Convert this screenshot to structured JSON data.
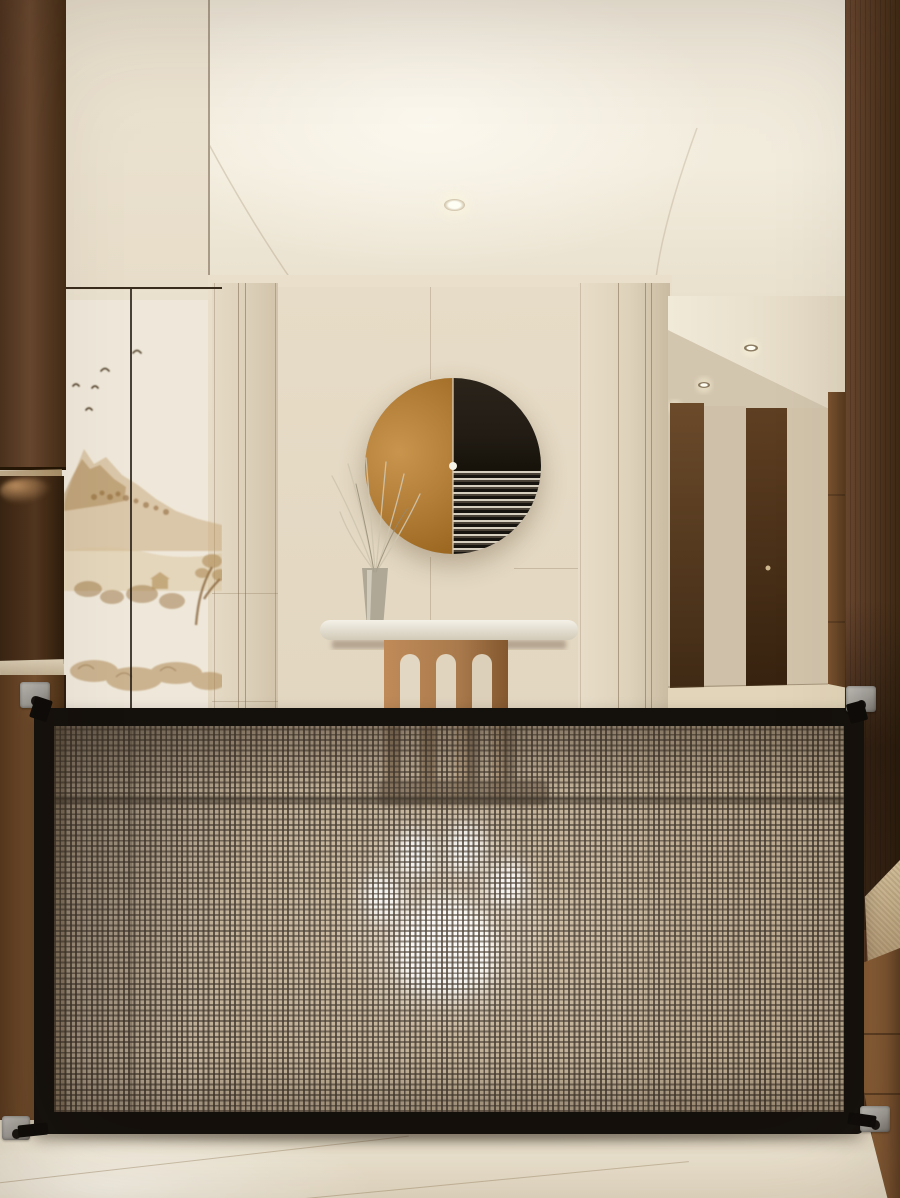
{
  "meta": {
    "title": "Entryway interior with retractable mesh pet safety gate",
    "media_type": "product photograph",
    "visible_text": ""
  },
  "colors": {
    "frame": "#14100c",
    "mesh_cell": "#c6b397",
    "mesh_line": "#362c22",
    "paw": "#ffffff",
    "ceiling": "#f0e9db",
    "wall": "#e7dcc7",
    "pillar": "#ddd1bb",
    "mural_bg": "#e9dcc2",
    "mural_ink": "#8a6434",
    "art_orange": "#b5803a",
    "art_dark": "#221c15",
    "art_streak": "#d6cfc0",
    "wood_dark": "#53371f",
    "wood_mid": "#7b5531",
    "wood_warm": "#a87a4e",
    "counter": "#d9cbb2",
    "door": "#5f3f22",
    "corridor_wall": "#d2c4ab",
    "corridor_floor": "#e3d5b9",
    "cushion": "#d9c3a0",
    "bench": "#91643a",
    "floor": "#ece1cc",
    "bracket": "#a09d98",
    "under_cabinet_glow": "#ffc98e"
  },
  "scene": {
    "labels": {
      "stage": "Photo of a cream entryway with a mesh pet safety gate stretched across the hallway",
      "gate": "Black-framed mesh pet safety gate",
      "mesh": "Brown woven safety mesh panel",
      "paw": "White paw print watermark on mesh",
      "bracket_tl": "Top left wall mounting bracket",
      "bracket_tr": "Top right wall mounting bracket",
      "bracket_bl": "Bottom left wall mounting bracket",
      "bracket_br": "Bottom right wall mounting bracket",
      "artwork": "Round two-tone wall art, orange half and black striped half",
      "console": "Console table with white stone top and arched wood legs",
      "vase": "Glass vase with dried branches",
      "mural": "Sepia mountain landscape mural with flying birds",
      "ceiling": "Cream cove ceiling with recessed downlights",
      "light_main_left": "Recessed ceiling downlight",
      "light_main_center": "Recessed ceiling downlight",
      "corridor": "Side hallway with wooden doors and recessed lights",
      "left_cabinets": "Dark walnut cabinetry with lit open shelf",
      "right_wood_wall": "Dark walnut wall paneling",
      "bench": "Wooden bench with beige cushion",
      "floor": "Pale cream stone floor"
    }
  }
}
